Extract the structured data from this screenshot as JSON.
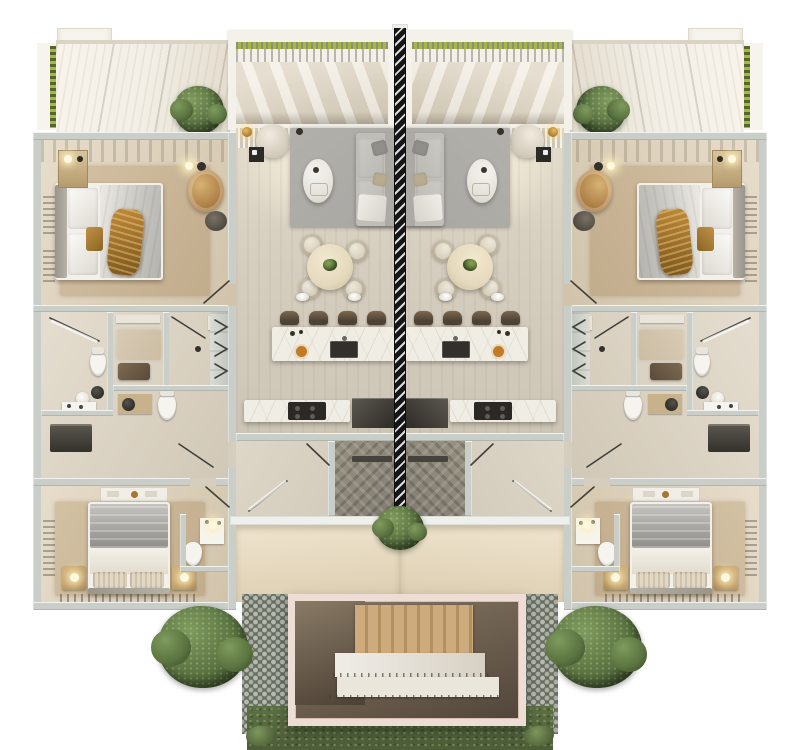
{
  "scene": {
    "type": "architectural-floorplan-3d-render",
    "view": "top-down duplex with mirrored twin units and hatched party wall",
    "units": [
      {
        "id": "left"
      },
      {
        "id": "right",
        "mirrored": true
      }
    ],
    "per_unit": {
      "roof_terrace": 1,
      "bedrooms": 2,
      "bathroom_rooms": 3,
      "kitchen_island": 1,
      "bar_stools": 4,
      "pendant_lights": 2,
      "dining_table": 1,
      "dining_chairs": 4,
      "sofa": 1,
      "armchair": 1,
      "rattan_chair": 1,
      "beds": 2,
      "nightstand_lamps": 2
    },
    "shared": {
      "party_wall_hatched": 1,
      "entry_stair_enclosure": 1,
      "cobblestone_paths": 2,
      "grass_strip": 1,
      "trees": 2,
      "terrace_shrubs": 2,
      "center_planter": 1
    }
  },
  "palette": {
    "bg": "#ffffff",
    "wall": "#c9cfc8",
    "wall-cap": "#eef0ec",
    "roof": "#f3efe6",
    "roof-edge": "#dbd4c5",
    "fascia": "#f7f4ed",
    "hedge": "#a9b545",
    "hedge-dark": "#55662a",
    "baluster-slot": "#b9b5aa",
    "terrace-floor": "#efe8da",
    "terrace-floor-dark": "#d8cfbd",
    "wood-warm": "#d2c4ab",
    "rug-beige": "#cbb795",
    "rug-gray": "#a9a7a2",
    "bed-white": "#f3f0ea",
    "duvet-gray": "#9d9c98",
    "throw-gold": "#a5762e",
    "chair-tan": "#b78c53",
    "sofa": "#c0beb9",
    "sofa-dark": "#abaaa5",
    "table-cream": "#e5d9bd",
    "marble": "#f0ede5",
    "appliance-dark": "#32302c",
    "stool-brown": "#4e4236",
    "stool-top": "#7d684c",
    "divider-black": "#151515",
    "divider-stripe": "#dcdcdc",
    "entry-floor": "#837d72",
    "porch-dark": "#dccdb0",
    "pink-frame": "#eeddd4",
    "stair-tan": "#cdab7c",
    "stair-light": "#eae6dc",
    "cobble": "#666c60",
    "cobble-light": "#b5baae",
    "cobble-mid": "#a9aea2",
    "grass": "#5d7045",
    "grass-dark": "#4c5d38",
    "tree": "#5a7340",
    "tree-dark": "#394e27",
    "tree-light": "#7f9b5d",
    "plant": "#5f7b3f",
    "white": "#f6f4ef"
  }
}
